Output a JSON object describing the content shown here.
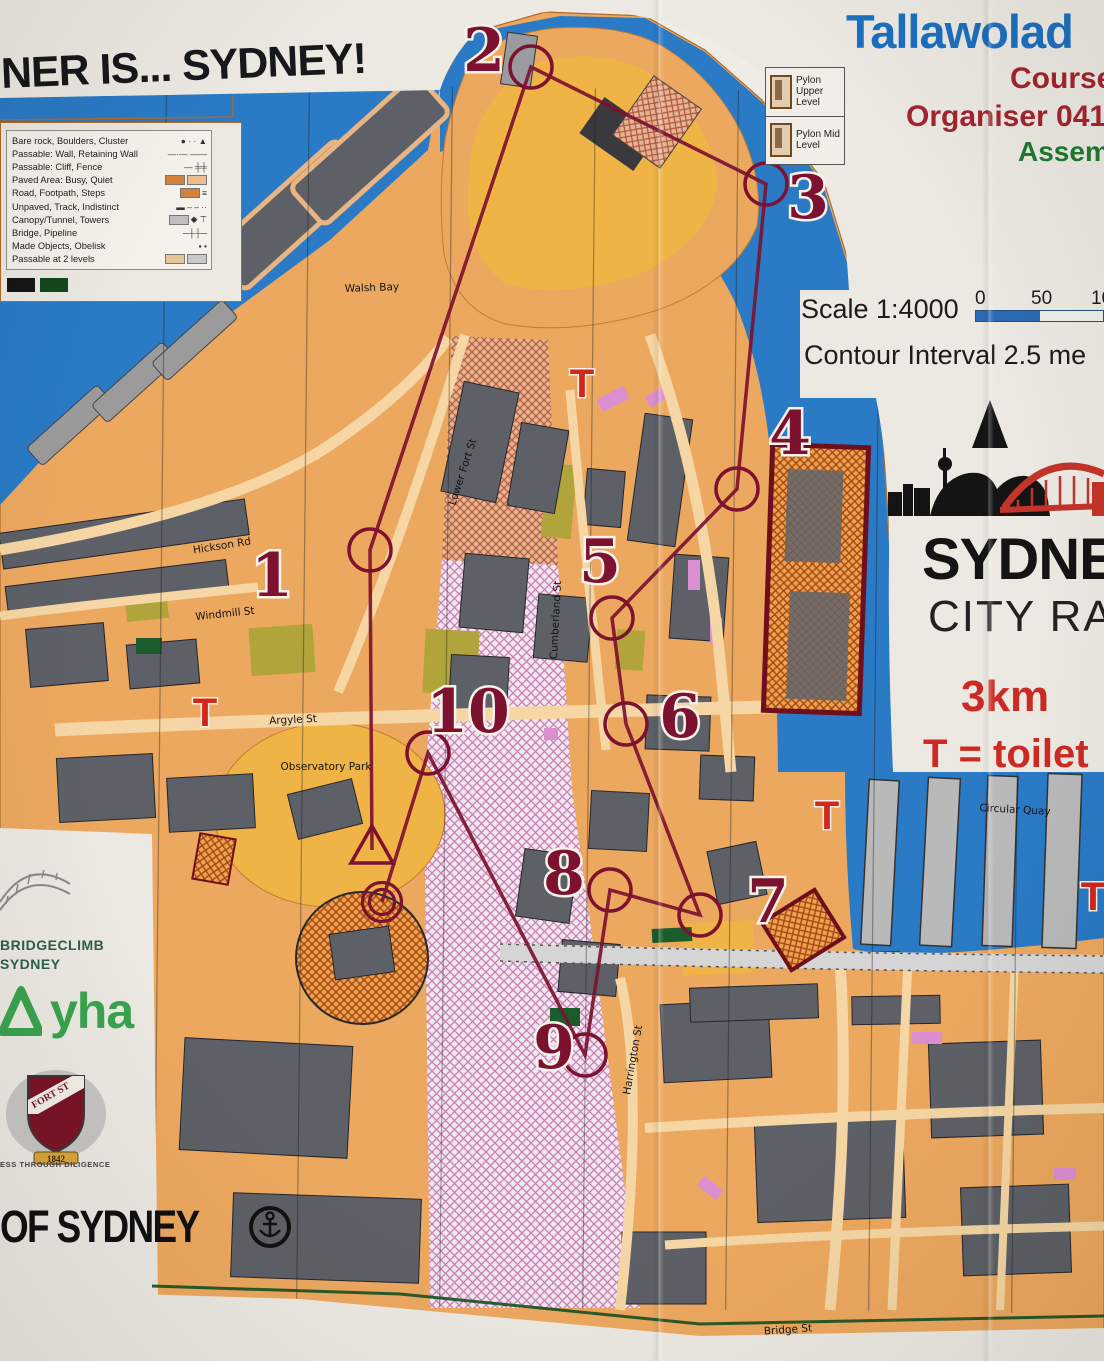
{
  "palette": {
    "paper": "#ebe9e1",
    "water_blue": "#2a7ac6",
    "paved_orange": "#eda85f",
    "park_orange": "#f0b345",
    "building_gray": "#5d6066",
    "olive": "#b0a43a",
    "pink_building": "#dc8fd0",
    "course_maroon": "#7c1230",
    "toilet_red": "#d3261c",
    "header_blue": "#1d6fc0",
    "header_red": "#a3242e",
    "header_green": "#1d7a33",
    "logo_red": "#cc2a22",
    "oob_border": "#6e0f1e",
    "boundary_green": "#145020"
  },
  "title": "NER IS... SYDNEY!",
  "event": {
    "name": "Tallawolad",
    "line2": "Course",
    "line3": "Organiser 041",
    "line4": "Assem"
  },
  "legend": {
    "items": [
      {
        "label": "Bare rock, Boulders, Cluster",
        "glyph": "● · · ▲",
        "swatches": []
      },
      {
        "label": "Passable: Wall, Retaining Wall",
        "glyph": "—·— ——",
        "swatches": []
      },
      {
        "label": "Passable: Cliff, Fence",
        "glyph": "— ╪╪",
        "swatches": []
      },
      {
        "label": "Paved Area: Busy, Quiet",
        "glyph": "",
        "swatches": [
          "#d4813a",
          "#edbd8d"
        ]
      },
      {
        "label": "Road, Footpath, Steps",
        "glyph": "≡",
        "swatches": [
          "#d4813a"
        ]
      },
      {
        "label": "Unpaved, Track, Indistinct",
        "glyph": "▬ – – ··",
        "swatches": []
      },
      {
        "label": "Canopy/Tunnel, Towers",
        "glyph": "◆ ⊤",
        "swatches": [
          "#bfbfbf"
        ]
      },
      {
        "label": "Bridge, Pipeline",
        "glyph": "─┼┼─",
        "swatches": []
      },
      {
        "label": "Made Objects, Obelisk",
        "glyph": "▪ •",
        "swatches": []
      },
      {
        "label": "Passable at 2 levels",
        "glyph": "",
        "swatches": [
          "#e8c49a",
          "#c9c9c9"
        ]
      }
    ],
    "extra_swatches": [
      "#161616",
      "#12491c"
    ]
  },
  "pylon_legend": [
    {
      "label": "Pylon Upper Level"
    },
    {
      "label": "Pylon Mid Level"
    }
  ],
  "map_info": {
    "scale": "Scale 1:4000",
    "scale_ticks": [
      "0",
      "50",
      "10"
    ],
    "contour": "Contour Interval 2.5 me"
  },
  "race_logo": {
    "line1": "SYDNEY",
    "line2": "CITY RACE",
    "distance": "3km",
    "toilet_note": "T = toilet"
  },
  "sponsors": {
    "bridgeclimb_line1": "BRIDGECLIMB",
    "bridgeclimb_line2": "SYDNEY",
    "yha": "yha",
    "crest_banner": "FORT ST",
    "crest_year": "1842",
    "crest_motto": "ESS THROUGH DILIGENCE",
    "city": "OF SYDNEY"
  },
  "course": {
    "start": {
      "x": 372,
      "y": 850
    },
    "finish": {
      "x": 382,
      "y": 902
    },
    "controls": [
      {
        "n": "1",
        "cx": 370,
        "cy": 550,
        "lx": 272,
        "ly": 574
      },
      {
        "n": "2",
        "cx": 531,
        "cy": 67,
        "lx": 484,
        "ly": 49
      },
      {
        "n": "3",
        "cx": 766,
        "cy": 184,
        "lx": 808,
        "ly": 196
      },
      {
        "n": "4",
        "cx": 737,
        "cy": 489,
        "lx": 790,
        "ly": 432
      },
      {
        "n": "5",
        "cx": 612,
        "cy": 618,
        "lx": 600,
        "ly": 560
      },
      {
        "n": "6",
        "cx": 626,
        "cy": 724,
        "lx": 680,
        "ly": 715
      },
      {
        "n": "7",
        "cx": 700,
        "cy": 915,
        "lx": 768,
        "ly": 900
      },
      {
        "n": "8",
        "cx": 610,
        "cy": 890,
        "lx": 564,
        "ly": 872
      },
      {
        "n": "9",
        "cx": 585,
        "cy": 1055,
        "lx": 554,
        "ly": 1046
      },
      {
        "n": "10",
        "cx": 428,
        "cy": 753,
        "lx": 468,
        "ly": 710
      }
    ],
    "toilets": [
      {
        "x": 582,
        "y": 383
      },
      {
        "x": 205,
        "y": 712
      },
      {
        "x": 827,
        "y": 815
      },
      {
        "x": 1093,
        "y": 896
      }
    ]
  },
  "streets": [
    {
      "name": "Walsh Bay",
      "x": 372,
      "y": 288,
      "rot": -2
    },
    {
      "name": "Hickson Rd",
      "x": 222,
      "y": 546,
      "rot": -9
    },
    {
      "name": "Windmill St",
      "x": 225,
      "y": 614,
      "rot": -6
    },
    {
      "name": "Argyle St",
      "x": 293,
      "y": 720,
      "rot": -3
    },
    {
      "name": "Observatory Park",
      "x": 326,
      "y": 767,
      "rot": 0
    },
    {
      "name": "Lower Fort St",
      "x": 463,
      "y": 472,
      "rot": -72
    },
    {
      "name": "Cumberland St",
      "x": 556,
      "y": 620,
      "rot": -87
    },
    {
      "name": "Harrington St",
      "x": 633,
      "y": 1060,
      "rot": -80
    },
    {
      "name": "Circular Quay",
      "x": 1015,
      "y": 810,
      "rot": 3
    },
    {
      "name": "Bridge St",
      "x": 788,
      "y": 1330,
      "rot": -4
    }
  ]
}
